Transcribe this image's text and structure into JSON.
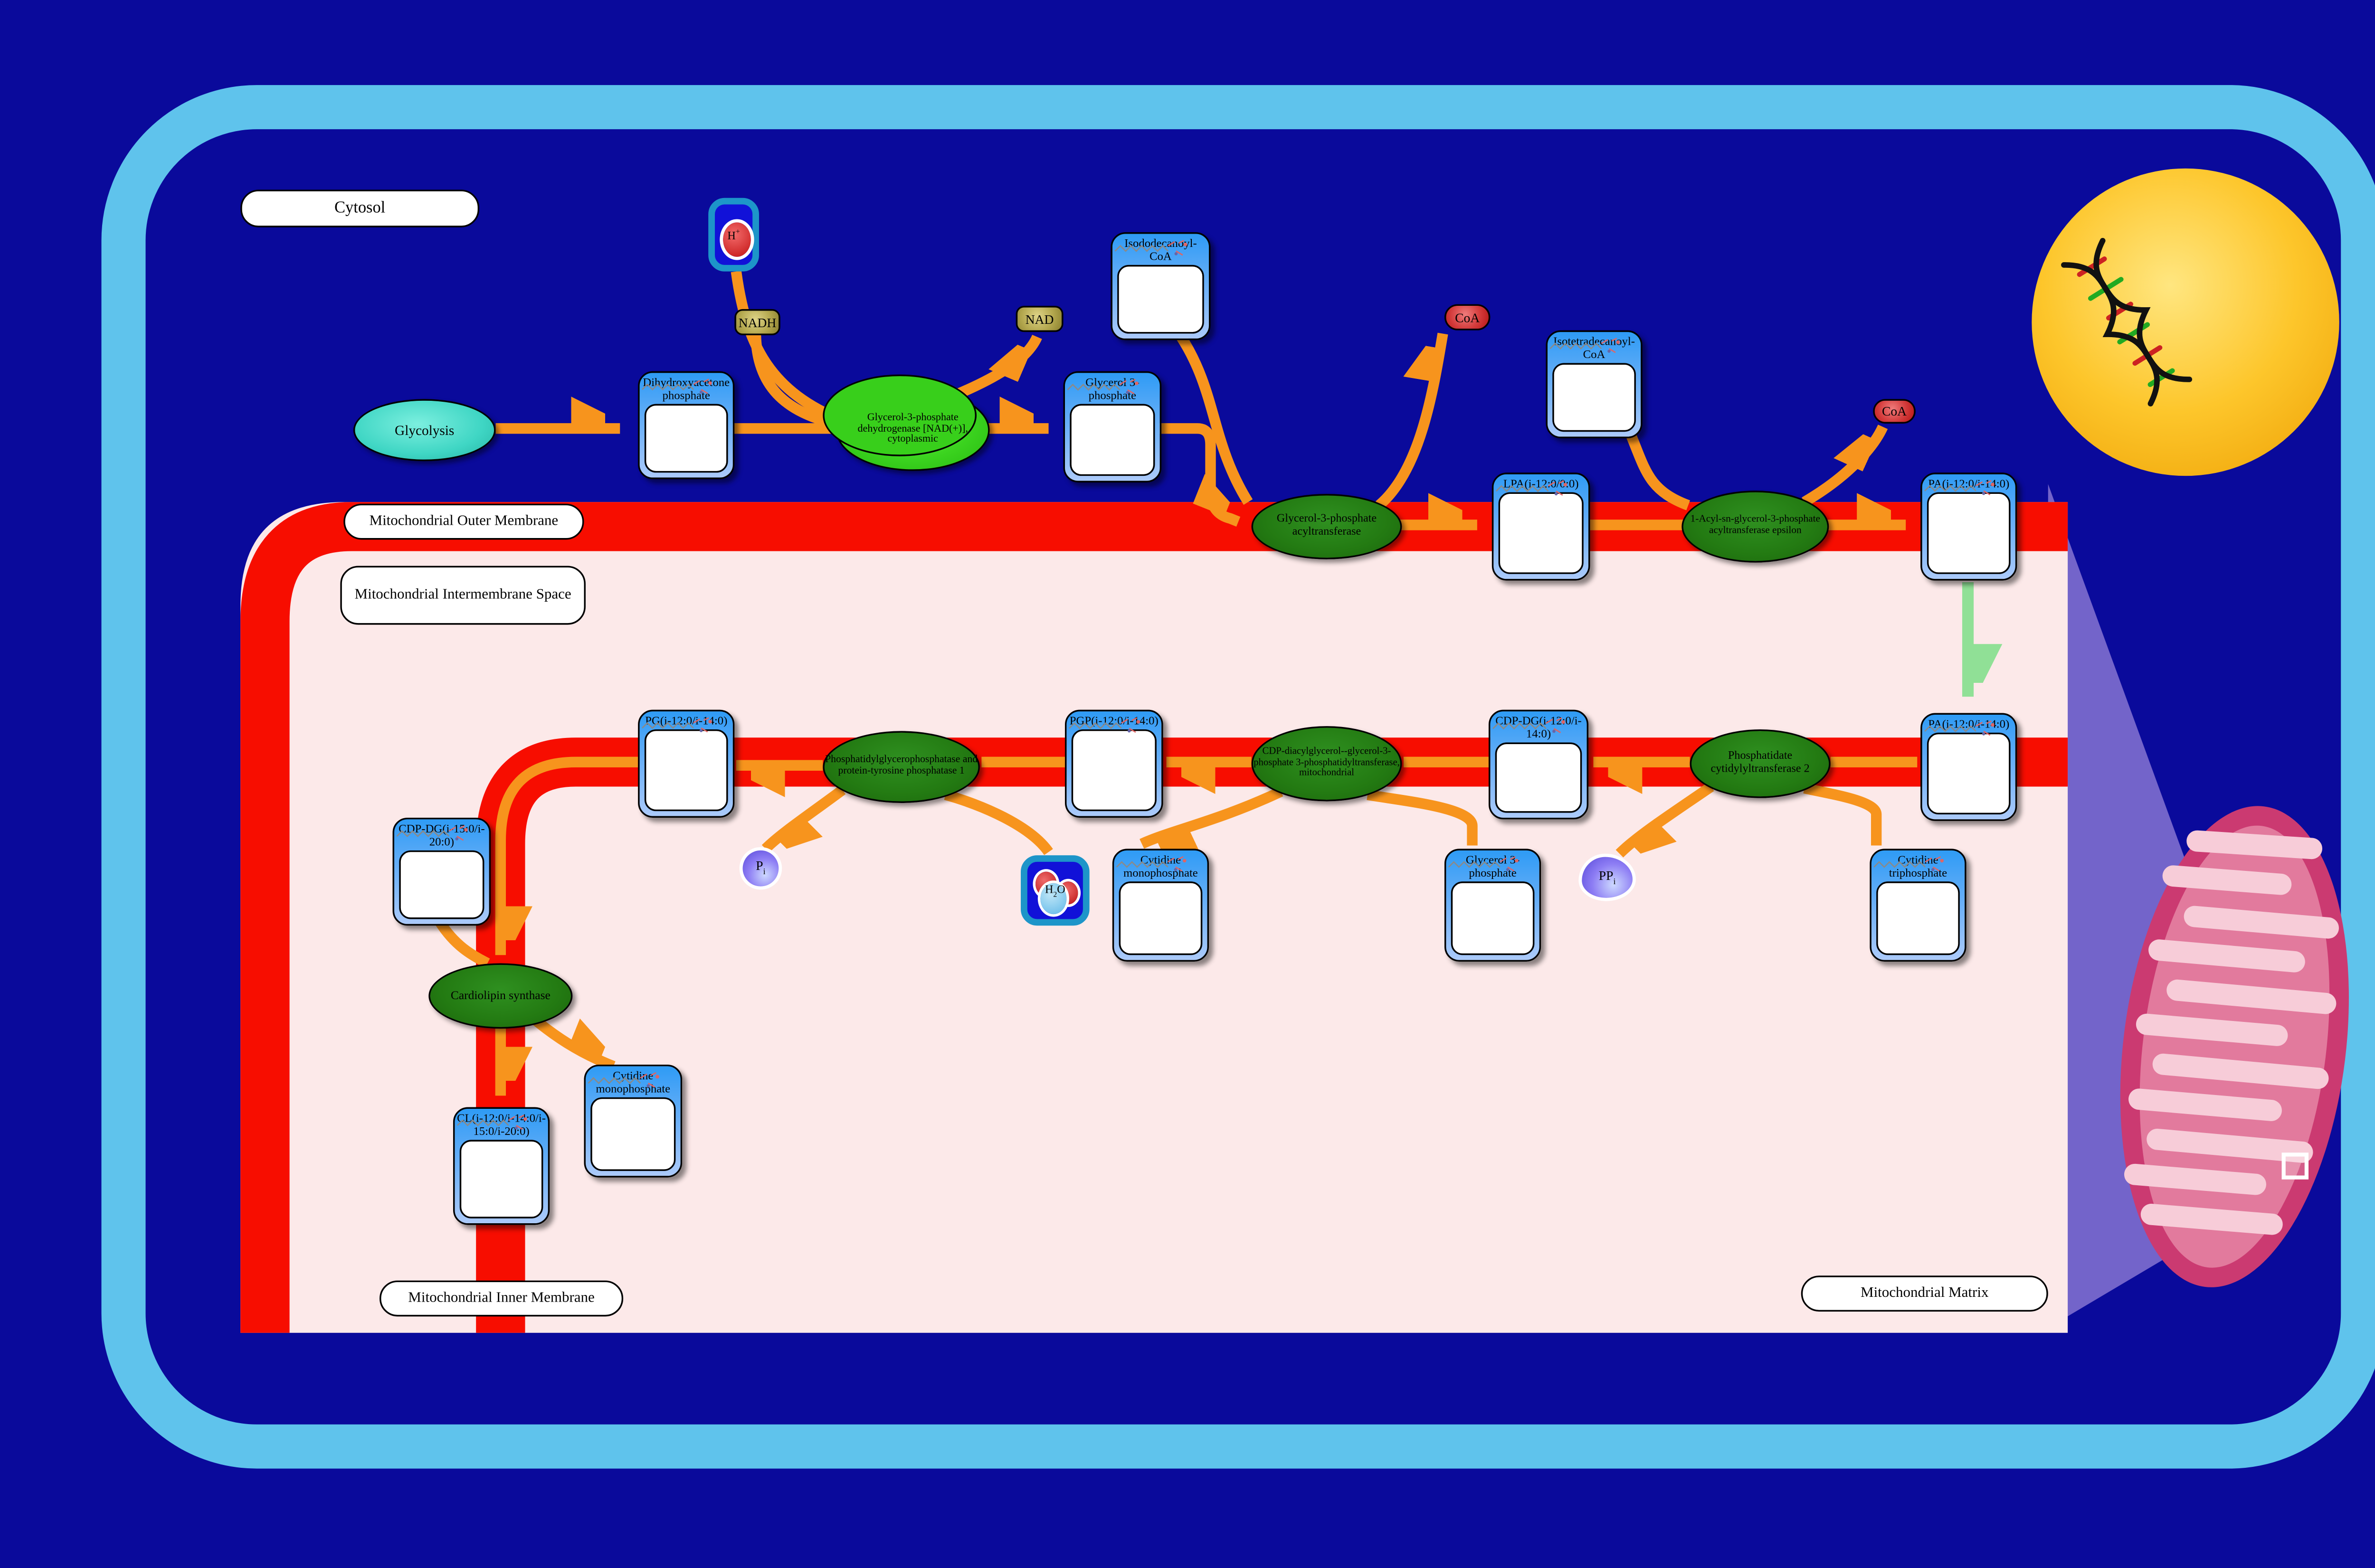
{
  "colors": {
    "background": "#0a0a9b",
    "cell_border": "#5fc3ec",
    "membrane_red": "#f70d00",
    "mito_interior": "#fce9e9",
    "arrow_orange": "#f7941d",
    "transport_arrow_green": "#90e096",
    "metabolite_card_blue": "#2e9bf5",
    "enzyme_green": "#237a12",
    "enzyme_bright_green": "#3bd31f",
    "process_teal": "#3fd6c4",
    "nucleus_yellow": "#fdc62b",
    "mitochondrion_pink": "#cb3a71"
  },
  "compartments": {
    "cytosol": "Cytosol",
    "outer_membrane": "Mitochondrial Outer Membrane",
    "intermembrane_space": "Mitochondrial Intermembrane Space",
    "inner_membrane": "Mitochondrial Inner Membrane",
    "matrix": "Mitochondrial Matrix"
  },
  "process": {
    "glycolysis": "Glycolysis"
  },
  "enzymes": [
    {
      "id": "gpd",
      "label": "Glycerol-3-phosphate dehydrogenase [NAD(+)], cytoplasmic"
    },
    {
      "id": "gpat",
      "label": "Glycerol-3-phosphate acyltransferase"
    },
    {
      "id": "agpat",
      "label": "1-Acyl-sn-glycerol-3-phosphate acyltransferase epsilon"
    },
    {
      "id": "cds2",
      "label": "Phosphatidate cytidylyltransferase 2"
    },
    {
      "id": "pgs1",
      "label": "CDP-diacylglycerol--glycerol-3-phosphate 3-phosphatidyltransferase, mitochondrial"
    },
    {
      "id": "ptpmt1",
      "label": "Phosphatidylglycerophosphatase and protein-tyrosine phosphatase 1"
    },
    {
      "id": "crls1",
      "label": "Cardiolipin synthase"
    }
  ],
  "metabolites": [
    {
      "id": "dhap",
      "label": "Dihydroxyacetone phosphate"
    },
    {
      "id": "g3p_cyto",
      "label": "Glycerol 3-phosphate"
    },
    {
      "id": "iso12",
      "label": "Isododecanoyl-CoA"
    },
    {
      "id": "iso14",
      "label": "Isotetradecanoyl-CoA"
    },
    {
      "id": "lpa",
      "label": "LPA(i-12:0/0:0)"
    },
    {
      "id": "pa_om",
      "label": "PA(i-12:0/i-14:0)"
    },
    {
      "id": "pa_im",
      "label": "PA(i-12:0/i-14:0)"
    },
    {
      "id": "cdpdg1",
      "label": "CDP-DG(i-12:0/i-14:0)"
    },
    {
      "id": "pgp",
      "label": "PGP(i-12:0/i-14:0)"
    },
    {
      "id": "pg",
      "label": "PG(i-12:0/i-14:0)"
    },
    {
      "id": "cdpdg2",
      "label": "CDP-DG(i-15:0/i-20:0)"
    },
    {
      "id": "cl",
      "label": "CL(i-12:0/i-14:0/i-15:0/i-20:0)"
    },
    {
      "id": "cmp1",
      "label": "Cytidine monophosphate"
    },
    {
      "id": "g3p_mat",
      "label": "Glycerol 3-phosphate"
    },
    {
      "id": "ctp",
      "label": "Cytidine triphosphate"
    },
    {
      "id": "cmp2",
      "label": "Cytidine monophosphate"
    }
  ],
  "cofactors": [
    {
      "id": "nadh",
      "label": "NADH"
    },
    {
      "id": "nad",
      "label": "NAD"
    },
    {
      "id": "coa1",
      "label": "CoA"
    },
    {
      "id": "coa2",
      "label": "CoA"
    },
    {
      "id": "hplus",
      "label": "H+"
    },
    {
      "id": "h2o",
      "label": "H2O"
    },
    {
      "id": "pi",
      "label": "Pi"
    },
    {
      "id": "ppi",
      "label": "PPi"
    }
  ]
}
